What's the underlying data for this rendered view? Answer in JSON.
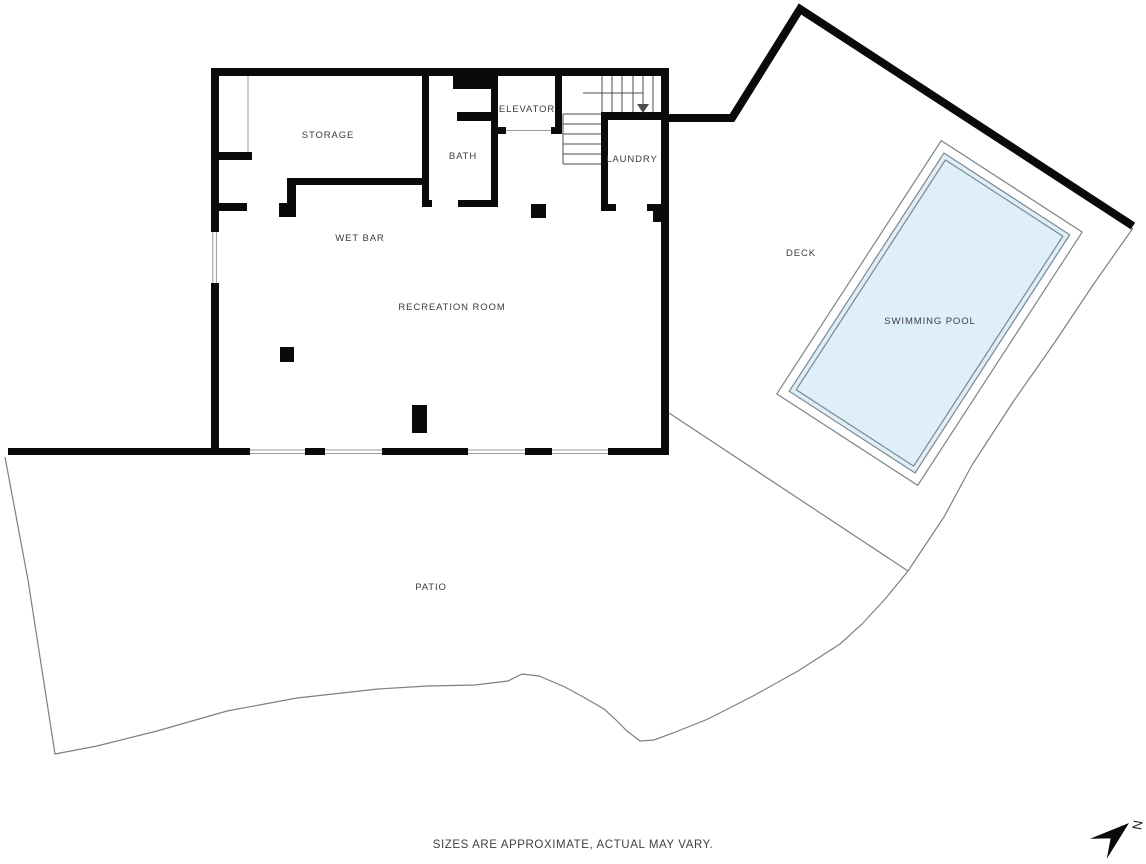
{
  "page": {
    "background_color": "#ffffff",
    "footer": {
      "disclaimer": "SIZES ARE APPROXIMATE, ACTUAL MAY VARY."
    },
    "compass": {
      "north_label": "N"
    }
  },
  "colors": {
    "wall": "#0a0a0a",
    "boundary": "#7f7f7f",
    "window_line": "#9a9a9a",
    "stair_line": "#4d4d4d",
    "label": "#3b3b3b",
    "footer_text": "#3f3f3f",
    "pool_fill": "#deeffa",
    "pool_stroke": "#7d868c"
  },
  "floor_plan": {
    "rooms": {
      "storage": {
        "label": "STORAGE"
      },
      "elevator": {
        "label": "ELEVATOR"
      },
      "bath": {
        "label": "BATH"
      },
      "laundry": {
        "label": "LAUNDRY"
      },
      "wet_bar": {
        "label": "WET BAR"
      },
      "recreation_room": {
        "label": "RECREATION ROOM"
      }
    },
    "outdoor_areas": {
      "deck": {
        "label": "DECK"
      },
      "swimming_pool": {
        "label": "SWIMMING POOL"
      },
      "patio": {
        "label": "PATIO"
      }
    }
  }
}
